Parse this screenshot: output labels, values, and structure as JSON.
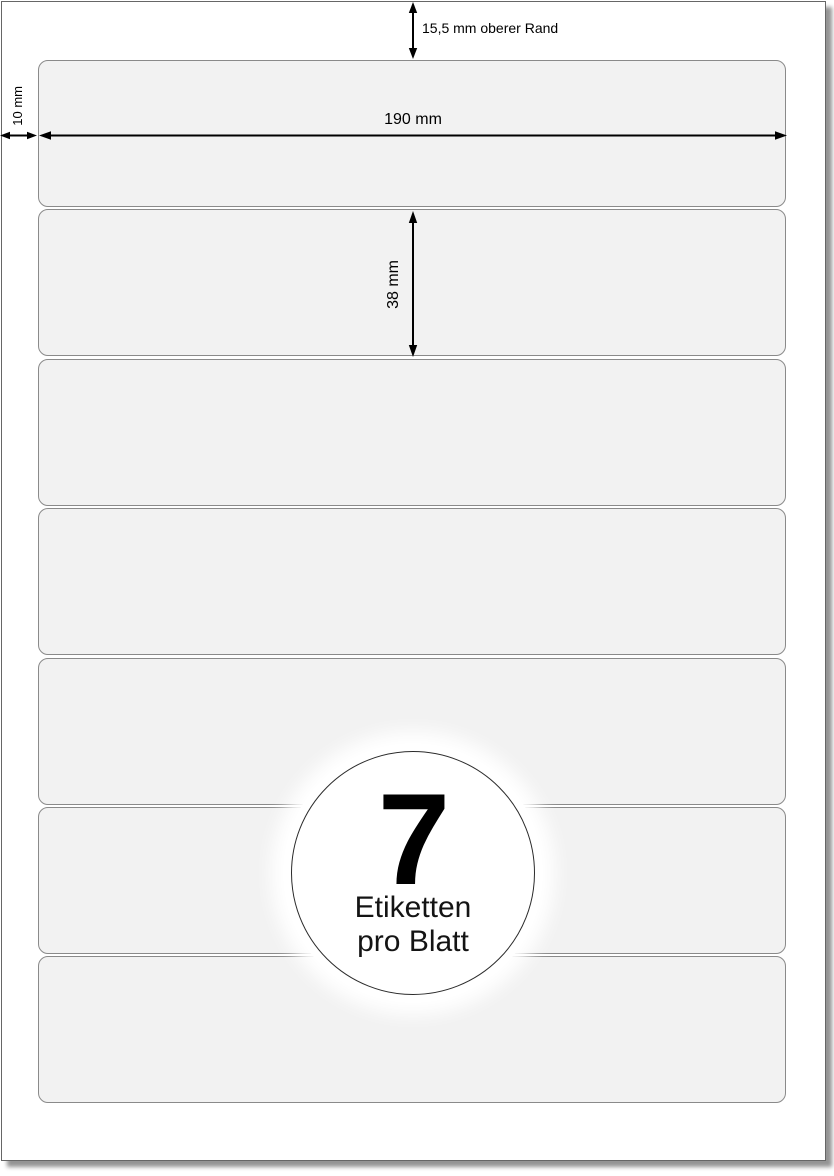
{
  "sheet": {
    "label_count": 7,
    "background": "#ffffff",
    "border_color": "#666666",
    "shadow_color": "#949494",
    "label_fill": "#f2f2f2",
    "label_border": "#8a8a8a"
  },
  "dimensions": {
    "top_margin": {
      "label": "15,5 mm oberer Rand"
    },
    "left_margin": {
      "label": "10 mm"
    },
    "label_width": {
      "label": "190 mm"
    },
    "label_height": {
      "label": "38 mm"
    },
    "arrow_color": "#000000"
  },
  "badge": {
    "count": "7",
    "line1": "Etiketten",
    "line2": "pro Blatt"
  }
}
